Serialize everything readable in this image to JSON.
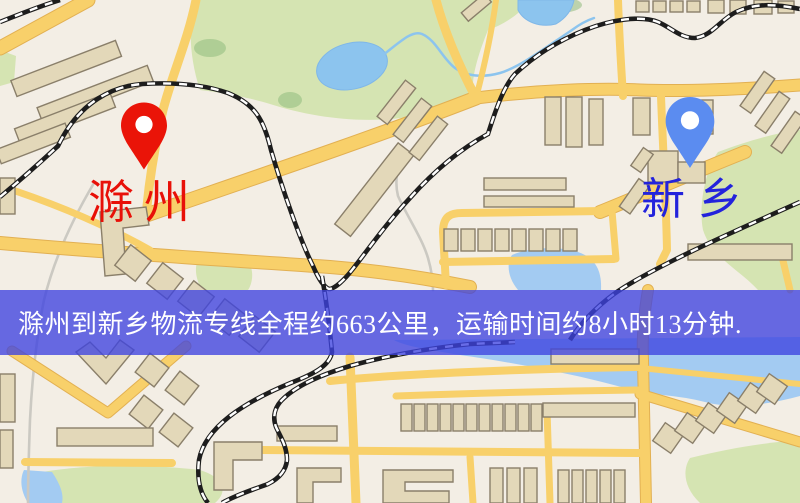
{
  "banner": {
    "text": "滁州到新乡物流专线全程约663公里，运输时间约8小时13分钟.",
    "origin_city": "滁州",
    "destination_city": "新乡",
    "distance_km": "663",
    "duration": "8小时13分钟"
  },
  "markers": {
    "chuzhou": {
      "label": "滁州"
    },
    "xinxiang": {
      "label": "新乡"
    }
  },
  "colors": {
    "map-bg": "#f3eee5",
    "road": "#f8d06a",
    "road-edge": "#e2b052",
    "building": "#e3d8b9",
    "building-stroke": "#8a7f6a",
    "park": "#d5e4b2",
    "park-dark": "#8fbb7e",
    "water": "#a3cbf2",
    "lake": "#8cc4ee",
    "rail": "#1d1d1d",
    "rail-dash": "#ffffff",
    "trail": "#cbc9c2",
    "banner-bg": "rgba(62,66,224,0.78)",
    "banner-text": "#ffffff",
    "pin-chuzhou": "#ea1408",
    "label-chuzhou": "#e81008",
    "pin-xinxiang": "#5b8cf0",
    "label-xinxiang": "#2323dc",
    "pin-hole": "#ffffff"
  }
}
